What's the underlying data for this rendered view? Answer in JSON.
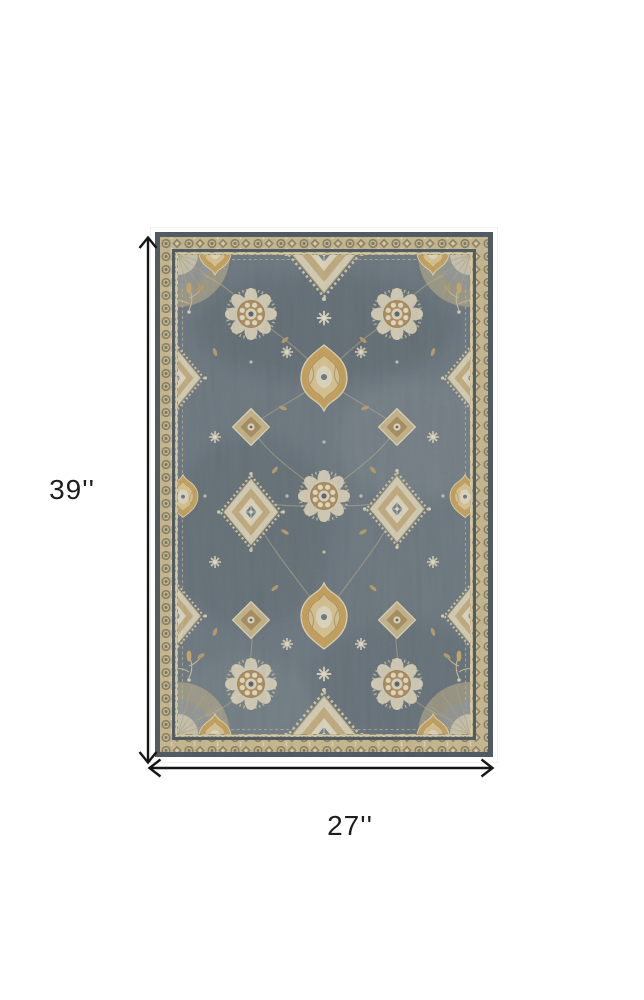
{
  "page": {
    "type": "product dimension diagram",
    "background_color": "#ffffff"
  },
  "product": {
    "description": "Rectangular traditional ornate area rug, slate blue-gray field with tan, gold and cream floral medallions, rosettes and vine pattern, framed by a tan ornamental border with dark blue-gray edge",
    "colors": {
      "field": "#6e7981",
      "field_dark": "#46525a",
      "edge_band": "#4e5960",
      "border_band": "#c9ba90",
      "motif_cream": "#d9d1ba",
      "motif_tan": "#b08f5e",
      "motif_gold": "#c7a25d"
    }
  },
  "dimensions": {
    "height": {
      "label": "39''"
    },
    "width": {
      "label": "27''"
    },
    "line_color": "#161616"
  }
}
